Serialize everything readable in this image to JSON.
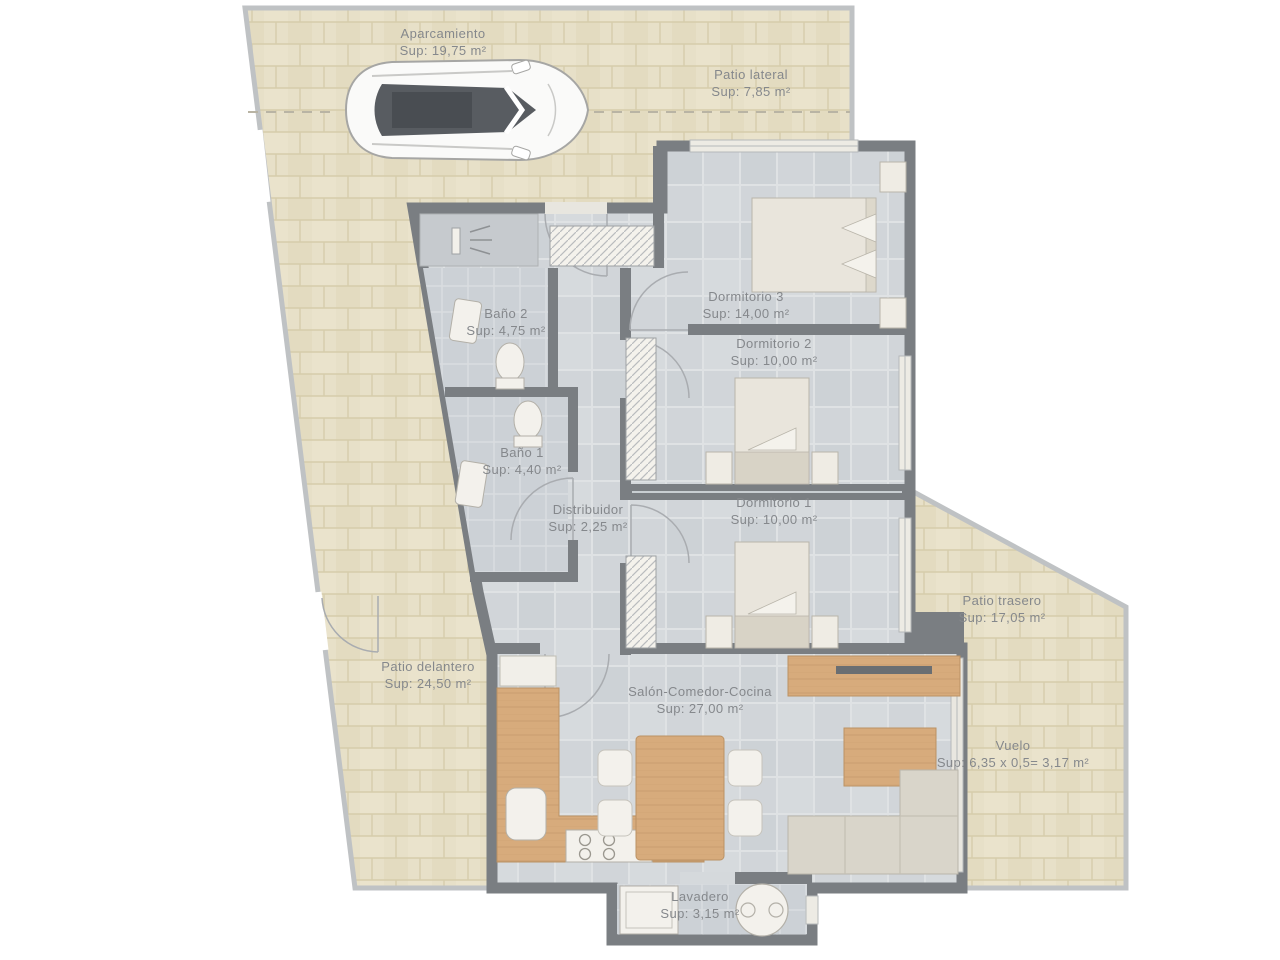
{
  "plan": {
    "type": "floor-plan",
    "rooms": [
      {
        "id": "aparcamiento",
        "name": "Aparcamiento",
        "sup": "Sup: 19,75 m²"
      },
      {
        "id": "patio-lateral",
        "name": "Patio lateral",
        "sup": "Sup: 7,85 m²"
      },
      {
        "id": "dormitorio-3",
        "name": "Dormitorio 3",
        "sup": "Sup: 14,00 m²"
      },
      {
        "id": "bano-2",
        "name": "Baño 2",
        "sup": "Sup: 4,75 m²"
      },
      {
        "id": "dormitorio-2",
        "name": "Dormitorio 2",
        "sup": "Sup: 10,00 m²"
      },
      {
        "id": "bano-1",
        "name": "Baño 1",
        "sup": "Sup: 4,40 m²"
      },
      {
        "id": "distribuidor",
        "name": "Distribuidor",
        "sup": "Sup: 2,25 m²"
      },
      {
        "id": "dormitorio-1",
        "name": "Dormitorio 1",
        "sup": "Sup: 10,00 m²"
      },
      {
        "id": "patio-trasero",
        "name": "Patio trasero",
        "sup": "Sup: 17,05 m²"
      },
      {
        "id": "patio-delantero",
        "name": "Patio delantero",
        "sup": "Sup: 24,50 m²"
      },
      {
        "id": "salon",
        "name": "Salón-Comedor-Cocina",
        "sup": "Sup: 27,00 m²"
      },
      {
        "id": "vuelo",
        "name": "Vuelo",
        "sup": "Sup: 6,35 x 0,5= 3,17 m²"
      },
      {
        "id": "lavadero",
        "name": "Lavadero",
        "sup": "Sup: 3,15 m²"
      }
    ],
    "colors": {
      "outdoor_tile": "#e7e0c8",
      "indoor_tile": "#d1d5d9",
      "wall": "#7a7e82",
      "boundary": "#bfc2c4",
      "wood": "#d7ab7c",
      "label_text": "#85888c",
      "background": "#ffffff"
    },
    "icons": [
      "car-icon",
      "shower-icon",
      "toilet-icon",
      "sink-icon",
      "washer-icon",
      "round-sink-icon"
    ]
  }
}
